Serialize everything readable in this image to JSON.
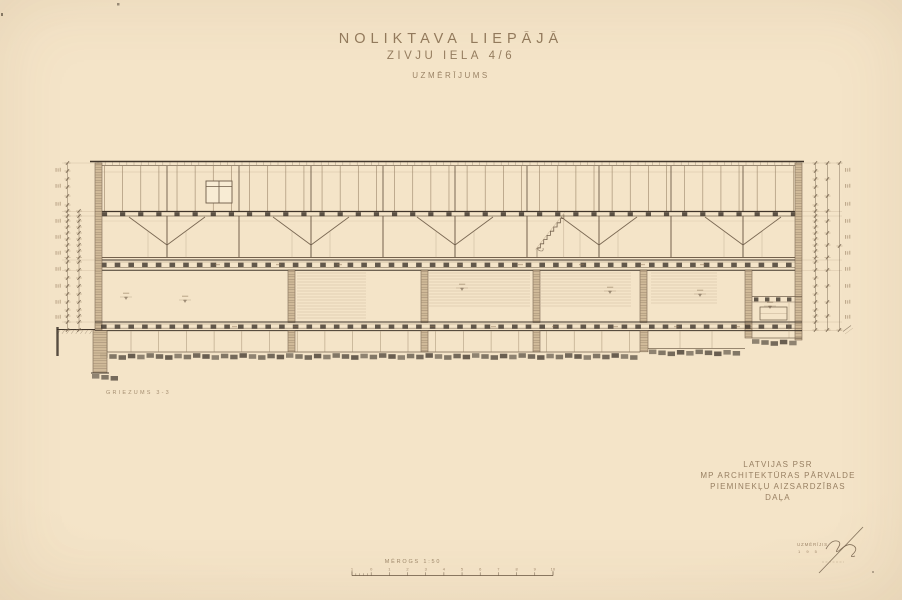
{
  "sheet": {
    "title_line1": "NOLIKTAVA LIEPĀJĀ",
    "title_line2": "ZIVJU IELĀ 4/6",
    "title_line3": "UZMĒRĪJUMS",
    "section_label": "GRIEZUMS 3-3",
    "agency_line1": "LATVIJAS PSR",
    "agency_line2": "MP ARCHITEKTŪRAS PĀRVALDE",
    "agency_line3": "PIEMINEKĻU AIZSARDZĪBAS",
    "agency_line4": "DAĻA",
    "signature_label": "UZMĒRĪJIS",
    "signature_year": "1 9 5",
    "scale_label": "MĒROGS 1:50",
    "scale_ticks": [
      "1",
      "0",
      "1",
      "2",
      "3",
      "4",
      "5",
      "6",
      "7",
      "8",
      "9",
      "10"
    ]
  },
  "colors": {
    "paper": "#f4e4c8",
    "ink_heavy": "#41362b",
    "ink_med": "#6d5b47",
    "ink_light": "#9a8468",
    "ink_faint": "#b9a485",
    "fill_dark": "#3c332a",
    "wall_fill": "#cdb694",
    "text_brown": "#8b7254"
  }
}
